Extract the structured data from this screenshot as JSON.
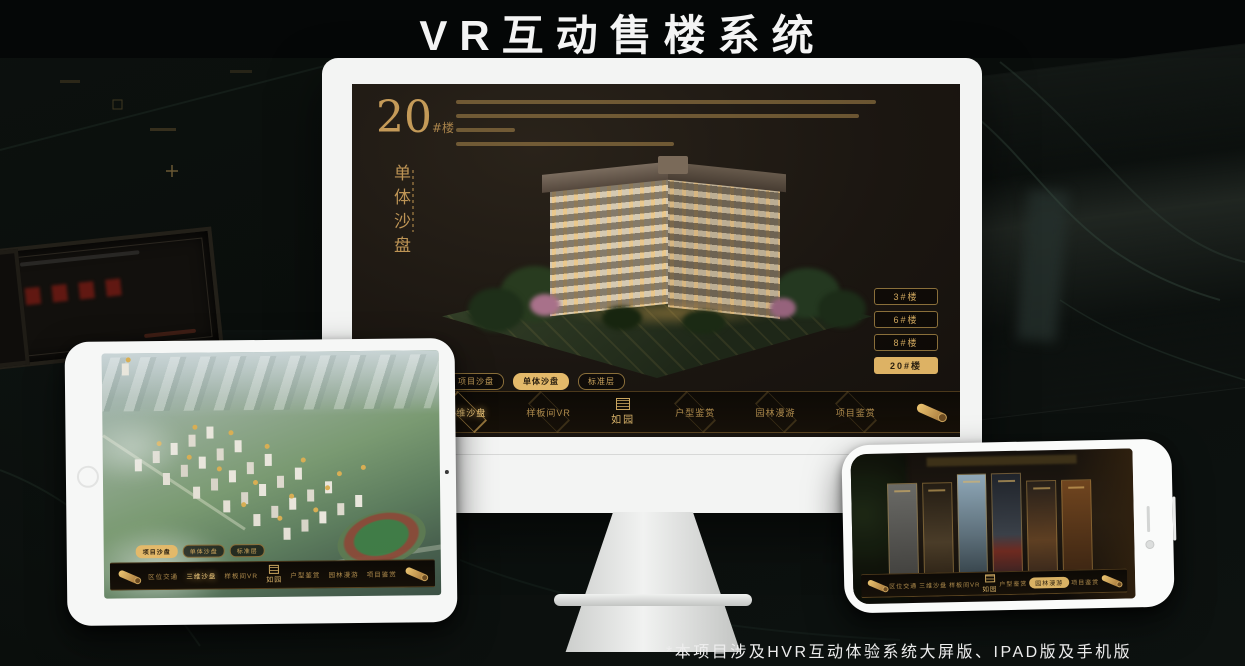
{
  "header": {
    "title": "VR互动售楼系统"
  },
  "footnote": "*本项目涉及HVR互动体验系统大屏版、IPAD版及手机版",
  "logo": {
    "name": "如园"
  },
  "view_tabs": [
    {
      "label": "项目沙盘"
    },
    {
      "label": "单体沙盘"
    },
    {
      "label": "标准层"
    }
  ],
  "nav_items": [
    {
      "label": "区位交通"
    },
    {
      "label": "三维沙盘"
    },
    {
      "label": "样板间VR"
    },
    {
      "label": "户型鉴赏"
    },
    {
      "label": "园林漫游"
    },
    {
      "label": "项目鉴赏"
    }
  ],
  "monitor_screen": {
    "building_number": "20",
    "building_unit": "#楼",
    "section_title": "单体沙盘",
    "floor_buttons": [
      {
        "label": "3#楼"
      },
      {
        "label": "6#楼"
      },
      {
        "label": "8#楼"
      },
      {
        "label": "20#楼",
        "active": true
      }
    ],
    "active_view_tab": "单体沙盘",
    "active_nav": "三维沙盘"
  },
  "tablet_screen": {
    "active_view_tab": "项目沙盘",
    "active_nav": "三维沙盘"
  },
  "phone_screen": {
    "active_nav": "园林漫游",
    "gallery_count": 6
  },
  "colors": {
    "gold": "#c49a5a",
    "gold_active_bg": "#ddb264",
    "dark_bg": "#0b0f0d",
    "screen_bg": "#1a1510",
    "title_text": "#f2f2f2"
  }
}
